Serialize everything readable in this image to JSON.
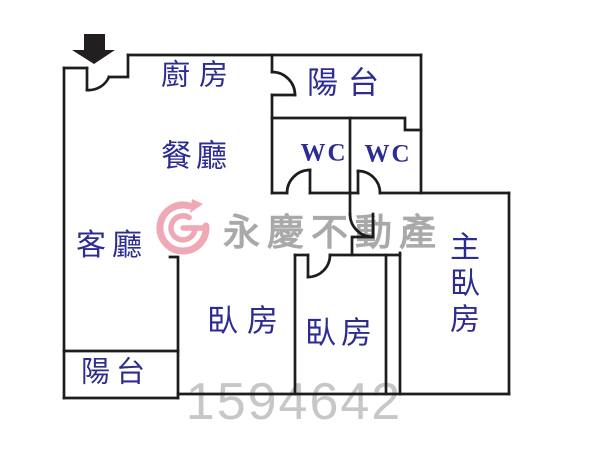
{
  "title": "apartment floor plan",
  "floorplan": {
    "wall_color": "#1d1d1d",
    "label_color": "#2c2c92",
    "entrance_arrow_color": "#231f20",
    "rooms": [
      {
        "id": "kitchen",
        "label": "廚房"
      },
      {
        "id": "balcony-top",
        "label": "陽台"
      },
      {
        "id": "dining",
        "label": "餐廳"
      },
      {
        "id": "wc-left",
        "label": "WC"
      },
      {
        "id": "wc-right",
        "label": "WC"
      },
      {
        "id": "living",
        "label": "客廳"
      },
      {
        "id": "bedroom-left",
        "label": "臥房"
      },
      {
        "id": "bedroom-middle",
        "label": "臥房"
      },
      {
        "id": "master-bedroom",
        "label": "主臥房"
      },
      {
        "id": "balcony-bottom",
        "label": "陽台"
      }
    ]
  },
  "watermark": {
    "brand_text": "永慶不動產",
    "brand_color": "#a9a9a9",
    "logo_color": "#efa9b6",
    "listing_number": "1594642",
    "number_color": "#c7c7c7"
  }
}
